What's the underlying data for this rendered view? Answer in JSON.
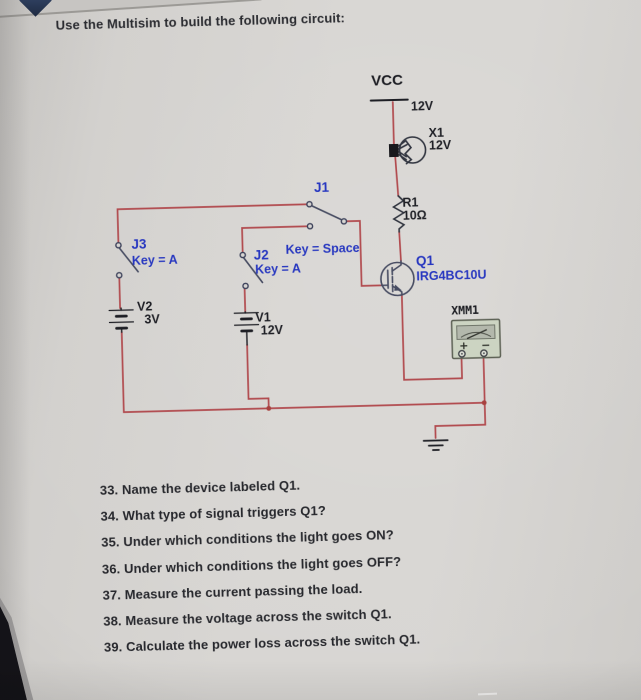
{
  "page": {
    "title": "Use the Multisim to build the following circuit:"
  },
  "circuit": {
    "vcc": {
      "net": "VCC",
      "value": "12V"
    },
    "lamp": {
      "ref": "X1",
      "value": "12V"
    },
    "resistor": {
      "ref": "R1",
      "value": "10Ω"
    },
    "igbt": {
      "ref": "Q1",
      "value": "IRG4BC10U"
    },
    "switch_j1": {
      "ref": "J1",
      "key": "Key = Space"
    },
    "switch_j2": {
      "ref": "J2",
      "key": "Key = A"
    },
    "switch_j3": {
      "ref": "J3",
      "key": "Key = A"
    },
    "battery_v2": {
      "ref": "V2",
      "value": "3V"
    },
    "battery_v1": {
      "ref": "V1",
      "value": "12V"
    },
    "multimeter": {
      "ref": "XMM1",
      "plus": "+",
      "minus": "−"
    },
    "colors": {
      "wire": "#b14a4e",
      "label_blue": "#2737c0",
      "label_black": "#1f2026",
      "paper": "#d6d4d1",
      "multimeter_body": "#ccd4c2"
    }
  },
  "questions": [
    "33. Name the device labeled Q1.",
    "34. What type of signal triggers Q1?",
    "35. Under which conditions the light goes ON?",
    "36. Under which conditions the light goes OFF?",
    "37. Measure the current passing the load.",
    "38. Measure the voltage across the switch Q1.",
    "39. Calculate the power loss across the switch Q1."
  ]
}
